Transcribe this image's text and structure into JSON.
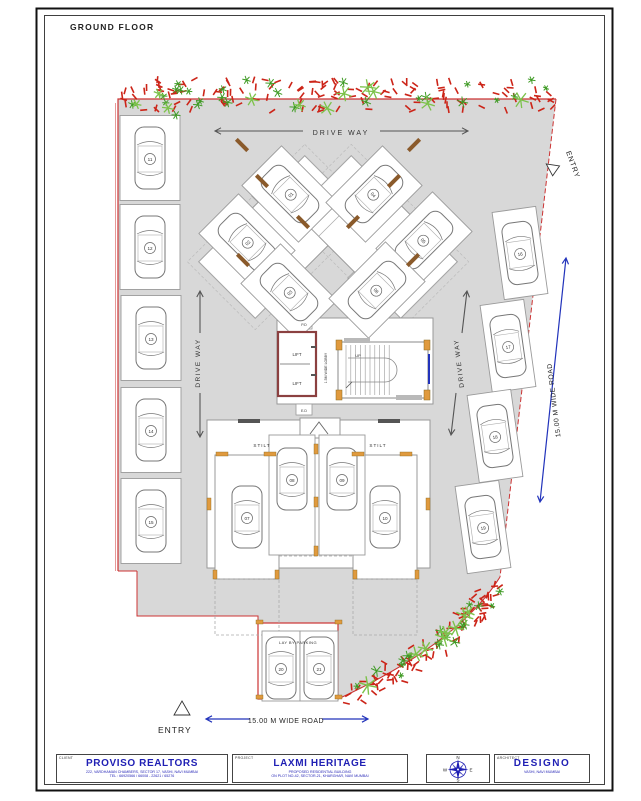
{
  "sheet": {
    "floor_title": "GROUND FLOOR"
  },
  "plan": {
    "driveway_top": "DRIVE WAY",
    "driveway_left": "DRIVE WAY",
    "driveway_right": "DRIVE WAY",
    "entry_top": "ENTRY",
    "entry_bottom": "ENTRY",
    "road_right": "15.00 M WIDE ROAD",
    "road_bottom": "15.00 M WIDE ROAD",
    "layby": "LAY BY PARKING",
    "stilt_left": "STILT",
    "stilt_right": "STILT",
    "core": {
      "lift_upper": "LIFT",
      "lift_lower": "LIFT",
      "stair_up": "UP",
      "lobby": "1.5M WIDE LOBBY",
      "duct_top": "P.D",
      "duct_bottom": "E.D"
    },
    "stalls": [
      {
        "no": "01",
        "x": 290,
        "y": 194,
        "r": -45,
        "cell": [
          290,
          194,
          56,
          80
        ]
      },
      {
        "no": "02",
        "x": 247,
        "y": 242,
        "r": -45,
        "cell": [
          247,
          242,
          56,
          80
        ]
      },
      {
        "no": "03",
        "x": 289,
        "y": 292,
        "r": -45,
        "cell": [
          289,
          292,
          56,
          80
        ]
      },
      {
        "no": "04",
        "x": 374,
        "y": 194,
        "r": 45,
        "cell": [
          374,
          194,
          56,
          80
        ]
      },
      {
        "no": "05",
        "x": 424,
        "y": 240,
        "r": 45,
        "cell": [
          424,
          240,
          56,
          80
        ]
      },
      {
        "no": "06",
        "x": 377,
        "y": 290,
        "r": 45,
        "cell": [
          377,
          290,
          56,
          80
        ]
      },
      {
        "no": "07",
        "x": 247,
        "y": 517,
        "r": 0,
        "cell": null
      },
      {
        "no": "08",
        "x": 292,
        "y": 479,
        "r": 0,
        "cell": [
          292,
          495,
          46,
          120
        ]
      },
      {
        "no": "09",
        "x": 342,
        "y": 479,
        "r": 0,
        "cell": [
          342,
          495,
          46,
          120
        ]
      },
      {
        "no": "10",
        "x": 385,
        "y": 517,
        "r": 0,
        "cell": null
      },
      {
        "no": "11",
        "x": 150,
        "y": 158,
        "r": 0,
        "cell": [
          150,
          158,
          60,
          85
        ]
      },
      {
        "no": "12",
        "x": 150,
        "y": 247,
        "r": 0,
        "cell": [
          150,
          247,
          60,
          85
        ]
      },
      {
        "no": "13",
        "x": 151,
        "y": 338,
        "r": 0,
        "cell": [
          151,
          338,
          60,
          85
        ]
      },
      {
        "no": "14",
        "x": 151,
        "y": 430,
        "r": 0,
        "cell": [
          151,
          430,
          60,
          85
        ]
      },
      {
        "no": "15",
        "x": 151,
        "y": 521,
        "r": 0,
        "cell": [
          151,
          521,
          60,
          85
        ]
      },
      {
        "no": "16",
        "x": 520,
        "y": 253,
        "r": -8,
        "cell": [
          520,
          253,
          44,
          88
        ]
      },
      {
        "no": "17",
        "x": 508,
        "y": 346,
        "r": -8,
        "cell": [
          508,
          346,
          44,
          88
        ]
      },
      {
        "no": "18",
        "x": 495,
        "y": 436,
        "r": -8,
        "cell": [
          495,
          436,
          44,
          88
        ]
      },
      {
        "no": "19",
        "x": 483,
        "y": 527,
        "r": -8,
        "cell": [
          483,
          527,
          44,
          88
        ]
      },
      {
        "no": "20",
        "x": 281,
        "y": 668,
        "r": 0,
        "cell": [
          281,
          666,
          38,
          70
        ]
      },
      {
        "no": "21",
        "x": 319,
        "y": 668,
        "r": 0,
        "cell": [
          319,
          666,
          38,
          70
        ]
      }
    ]
  },
  "title_block": {
    "client": {
      "tag": "CLIENT",
      "name": "PROVISO REALTORS",
      "lines": [
        "222, VARDHAMAN CHAMBERS, SECTOR 17, VASHI, NAVI MUMBAI",
        "TEL : 66920566 / 66008 - 22621 / 65276"
      ]
    },
    "project": {
      "tag": "PROJECT",
      "name": "LAXMI HERITAGE",
      "lines": [
        "PROPOSED RESIDENTIAL BUILDING",
        "ON PLOT NO-42, SECTOR-21, KHARGHAR, NAVI MUMBAI"
      ]
    },
    "compass": {
      "n": "N",
      "e": "E",
      "s": "S",
      "w": "W"
    },
    "architect": {
      "tag": "ARCHITECT",
      "name": "DESIGNO",
      "lines": [
        "VASHI, NAVI MUMBAI"
      ]
    }
  },
  "colors": {
    "plot_gray": "#d8d8d8",
    "boundary_red": "#cc3333",
    "accent_blue": "#2233bb",
    "title_blue": "#1f1fb4",
    "hedge_red": "#cc2418",
    "hedge_green": "#3f9b25",
    "hedge_light_green": "#7cc24a",
    "column_orange": "#e09a3e",
    "lift_red": "#8b4040"
  }
}
